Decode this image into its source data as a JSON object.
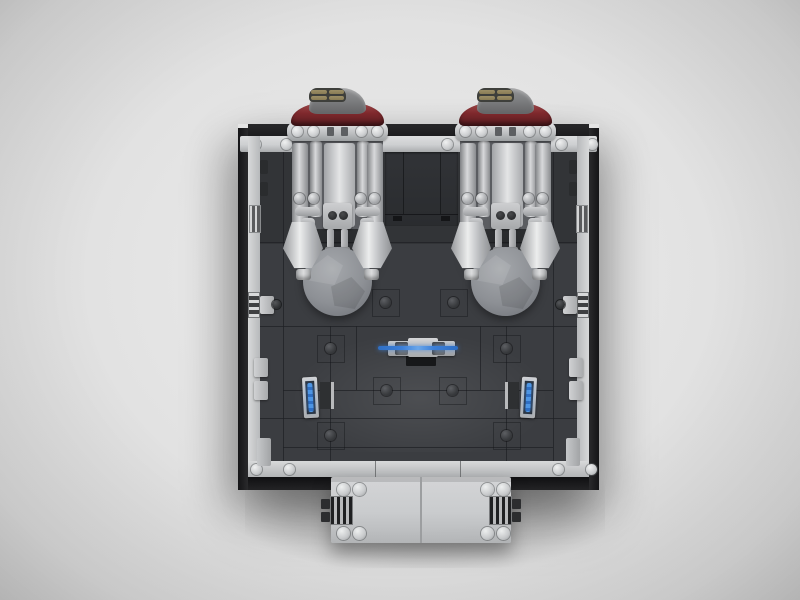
{
  "scene": {
    "description": "Top-down 3D render of a LEGO-style starship engine bay module",
    "view": "top-down",
    "room_label": "engine bay interior",
    "door_label": "rear bulkhead door",
    "airlock_label": "forward entry module with air vents"
  },
  "colors": {
    "bg": "#ececec",
    "wall_black": "#1d1d1f",
    "trim_light": "#cdcfd1",
    "floor_dark": "#3b3d41",
    "engine_gray": "#b7b9bc",
    "dome_red": "#7e282c",
    "dome_window_tan": "#897c55",
    "boulder_gray": "#8d9095",
    "accent_blue": "#3c7fd8",
    "hologram_blue": "#4d95e4",
    "module_gray": "#c9cbcd",
    "vent_black": "#1f2022"
  },
  "objects": {
    "engine_left": {
      "label": "left engine assembly with dark red dome and twin exhaust cones"
    },
    "engine_right": {
      "label": "right engine assembly with dark red dome and twin exhaust cones"
    },
    "boulder": {
      "label": "gray boulder sphere",
      "count": 2
    },
    "weapon_rack": {
      "label": "center rack holding blue-bladed staff"
    },
    "console_left": {
      "label": "left wall console with blue hologram"
    },
    "console_right": {
      "label": "right wall console with blue hologram"
    },
    "airlock": {
      "label": "bottom airlock module",
      "vent_count": 2
    },
    "exhaust_cones": {
      "count": 4
    },
    "floor_studs": {
      "count": 8
    }
  }
}
